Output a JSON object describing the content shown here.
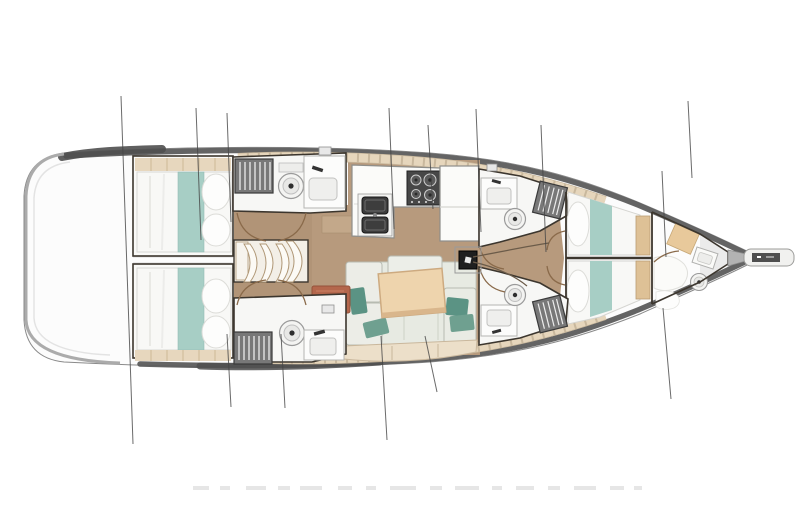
{
  "page": {
    "title": "Sailing yacht deck / interior layout plan",
    "type": "floor-plan",
    "orientation": "bow-right"
  },
  "vessel": {
    "areas": [
      {
        "id": "stern-deck",
        "label": "Stern deck"
      },
      {
        "id": "aft-cabin-port",
        "label": "Aft double cabin (port)"
      },
      {
        "id": "aft-cabin-starboard",
        "label": "Aft double cabin (starboard)"
      },
      {
        "id": "aft-head-port",
        "label": "Aft head with toilet and sink (port)"
      },
      {
        "id": "aft-head-starboard",
        "label": "Aft head with toilet and sink (starboard)"
      },
      {
        "id": "companionway-stairs",
        "label": "Companionway stairs"
      },
      {
        "id": "galley",
        "label": "Galley with stove and double sink"
      },
      {
        "id": "salon",
        "label": "Salon seating with table"
      },
      {
        "id": "nav-seat",
        "label": "Navigation seat"
      },
      {
        "id": "mast-base",
        "label": "Mast base"
      },
      {
        "id": "forward-head-port",
        "label": "Forward head (port)"
      },
      {
        "id": "forward-head-starboard",
        "label": "Forward head (starboard)"
      },
      {
        "id": "forward-cabin-port",
        "label": "Forward cabin (port)"
      },
      {
        "id": "forward-cabin-starboard",
        "label": "Forward cabin (starboard)"
      },
      {
        "id": "bow-cabin",
        "label": "Bow crew cabin with toilet and sink"
      },
      {
        "id": "anchor-locker",
        "label": "Anchor locker"
      },
      {
        "id": "bowsprit",
        "label": "Bowsprit / anchor roller"
      }
    ],
    "icons": [
      {
        "id": "toilet-icon",
        "shape": "circle-with-dot"
      },
      {
        "id": "sink-icon",
        "shape": "basin-with-faucet"
      },
      {
        "id": "stove-icon",
        "shape": "dark-panel-with-burners"
      },
      {
        "id": "hanging-locker-icon",
        "shape": "dark-box-with-hanger-stripes"
      },
      {
        "id": "mast-icon",
        "shape": "black-square"
      },
      {
        "id": "vent-icon",
        "shape": "small-grey-grate"
      }
    ],
    "colors": {
      "hull_white": "#fcfcfc",
      "gunwale_grey": "#5c5c5c",
      "floor_tan": "#b79a7d",
      "side_deck_beige": "#e6d6bc",
      "bedding_white": "#f8f8f6",
      "bedding_teal": "#a7cec5",
      "pillow_teal": "#5b9384",
      "sofa_grey_green": "#e7eae2",
      "bench_cream": "#ecdfc9",
      "table_tan": "#eed4ad",
      "nav_seat_terracotta": "#b4674c",
      "locker_grey": "#787878",
      "appliance_dark": "#3d3d3d",
      "wall_dark": "#3c362e"
    }
  }
}
